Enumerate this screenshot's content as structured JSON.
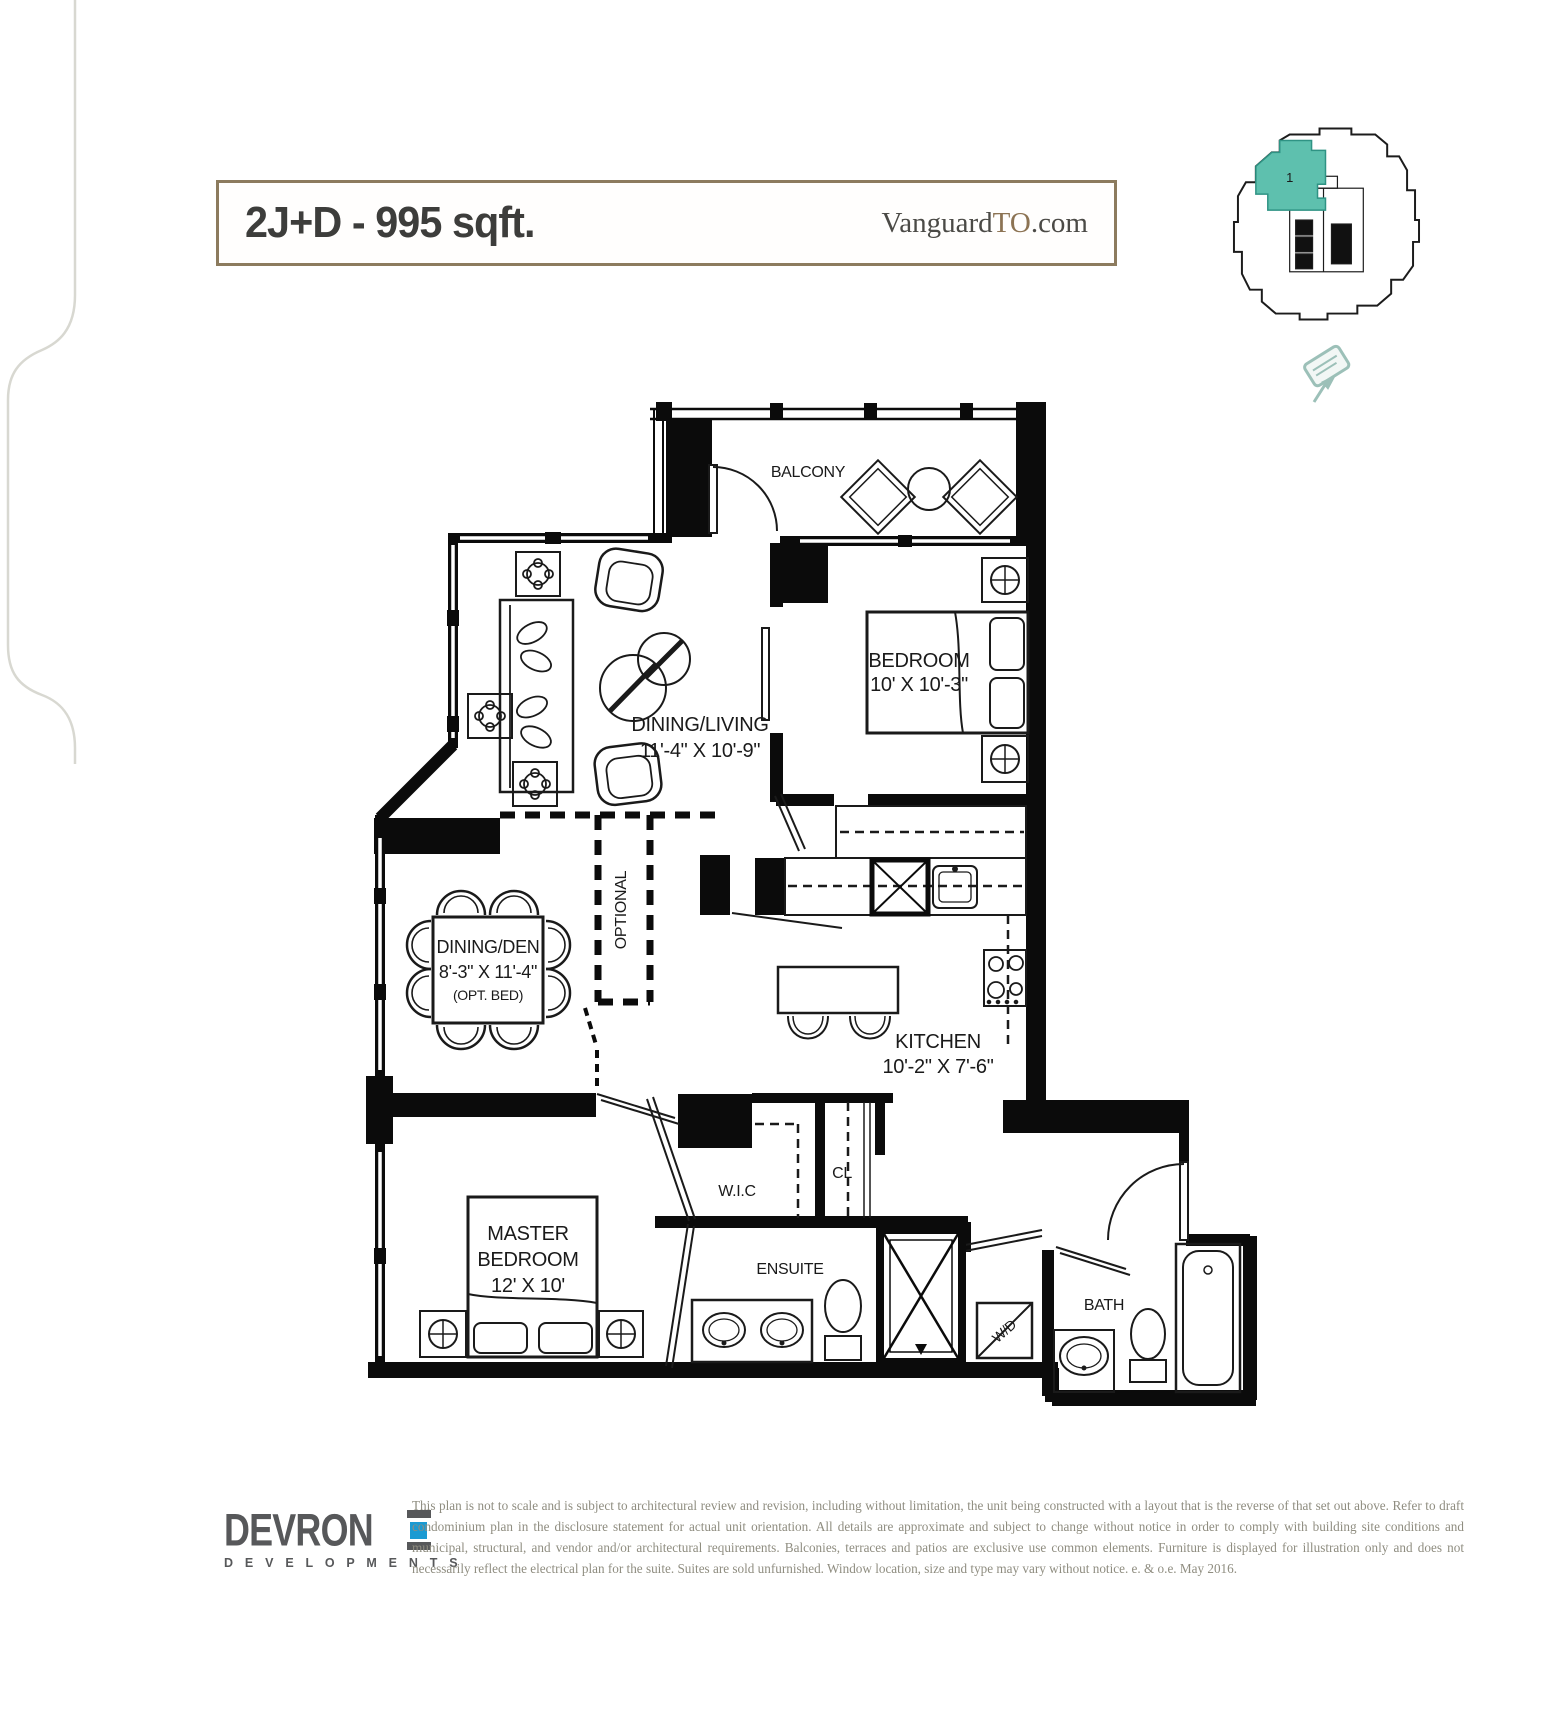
{
  "header": {
    "title": "2J+D - 995 sqft.",
    "website_prefix": "Vanguard",
    "website_accent": "TO",
    "website_suffix": ".com",
    "border_color": "#8c7b5e"
  },
  "keyplan": {
    "unit_number": "1",
    "unit_color": "#5ec0ae"
  },
  "rooms": {
    "balcony": {
      "name": "BALCONY"
    },
    "dining_living": {
      "name": "DINING/LIVING",
      "dims": "11'-4\" X 10'-9\""
    },
    "bedroom": {
      "name": "BEDROOM",
      "dims": "10' X 10'-3\""
    },
    "dining_den": {
      "name": "DINING/DEN",
      "dims": "8'-3\" X 11'-4\"",
      "note": "(OPT. BED)"
    },
    "optional_label": "OPTIONAL",
    "kitchen": {
      "name": "KITCHEN",
      "dims": "10'-2\" X 7'-6\""
    },
    "master_bedroom": {
      "line1": "MASTER",
      "line2": "BEDROOM",
      "dims": "12' X 10'"
    },
    "wic": {
      "name": "W.I.C"
    },
    "cl": {
      "name": "CL"
    },
    "ensuite": {
      "name": "ENSUITE"
    },
    "wd": {
      "name": "W/D"
    },
    "bath": {
      "name": "BATH"
    }
  },
  "footer": {
    "logo_text": "DEVRON",
    "logo_subtext": "D E V E L O P M E N T S",
    "logo_color": "#57585a",
    "logo_accent": "#1b9ad2",
    "disclaimer": "This plan is not to scale and is subject to architectural review and revision, including without limitation, the unit being constructed with a layout that is the reverse of that set out above. Refer to draft condominium plan in the disclosure statement for actual unit orientation. All details are approximate and subject to change without notice in order to comply with building site conditions and municipal, structural, and vendor and/or architectural requirements. Balconies, terraces and patios are exclusive use common elements. Furniture is displayed for illustration only and does not necessarily reflect the electrical plan for the suite. Suites are sold unfurnished. Window location, size and type may vary without notice. e. & o.e. May 2016."
  }
}
